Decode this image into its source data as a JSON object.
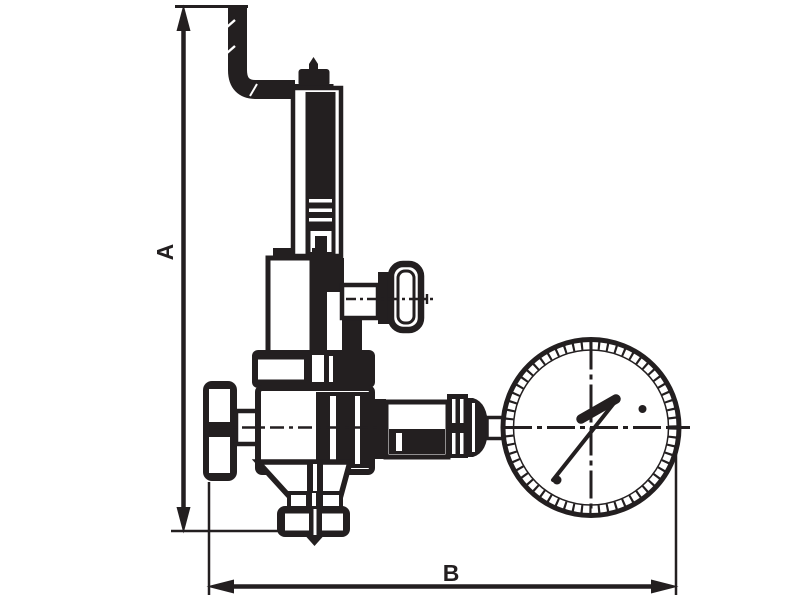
{
  "drawing": {
    "description": "Black-and-white technical dimensional drawing of a safety relief valve: vent elbow pipe at top, spring housing, side T-knob, inlet union at left, outlet union at right connected to a round pressure gauge, bottom flange, with overall height and length dimension arrows",
    "labels": {
      "dim_vertical": "A",
      "dim_horizontal": "B"
    },
    "colors": {
      "ink": "#231f20",
      "background": "#ffffff"
    }
  }
}
